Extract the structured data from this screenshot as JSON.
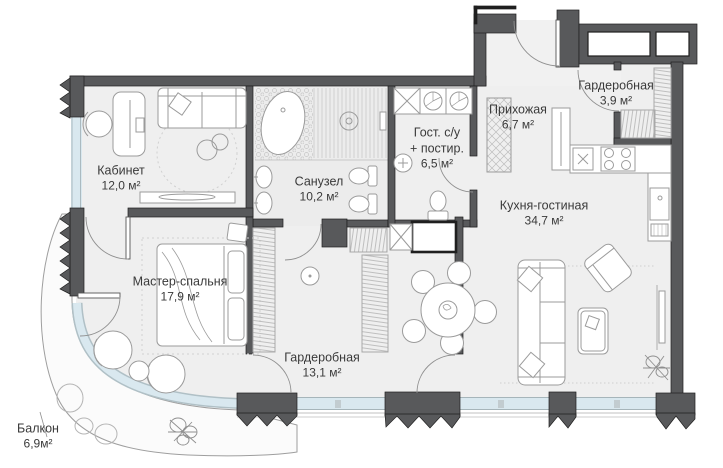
{
  "plan": {
    "title": "apartment-floor-plan",
    "colors": {
      "wall": "#58595b",
      "wall_outline": "#1f1f1f",
      "glass": "#d9e8ef",
      "floor": "#efefef",
      "furniture_line": "#9b9b9b",
      "text": "#3a3a3a"
    },
    "rooms": [
      {
        "id": "office",
        "name": "Кабинет",
        "area": "12,0 м²"
      },
      {
        "id": "bathroom",
        "name": "Санузел",
        "area": "10,2 м²"
      },
      {
        "id": "guest-wc",
        "name": "Гост. с/у",
        "name2": "+ постир.",
        "area": "6,5 м²"
      },
      {
        "id": "hallway",
        "name": "Прихожая",
        "area": "6,7 м²"
      },
      {
        "id": "wardrobe-small",
        "name": "Гардеробная",
        "area": "3,9 м²"
      },
      {
        "id": "kitchen-living",
        "name": "Кухня-гостиная",
        "area": "34,7 м²"
      },
      {
        "id": "master-bedroom",
        "name": "Мастер-спальня",
        "area": "17,9 м²"
      },
      {
        "id": "wardrobe-large",
        "name": "Гардеробная",
        "area": "13,1 м²"
      },
      {
        "id": "balcony",
        "name": "Балкон",
        "area": "6,9м²"
      }
    ]
  }
}
